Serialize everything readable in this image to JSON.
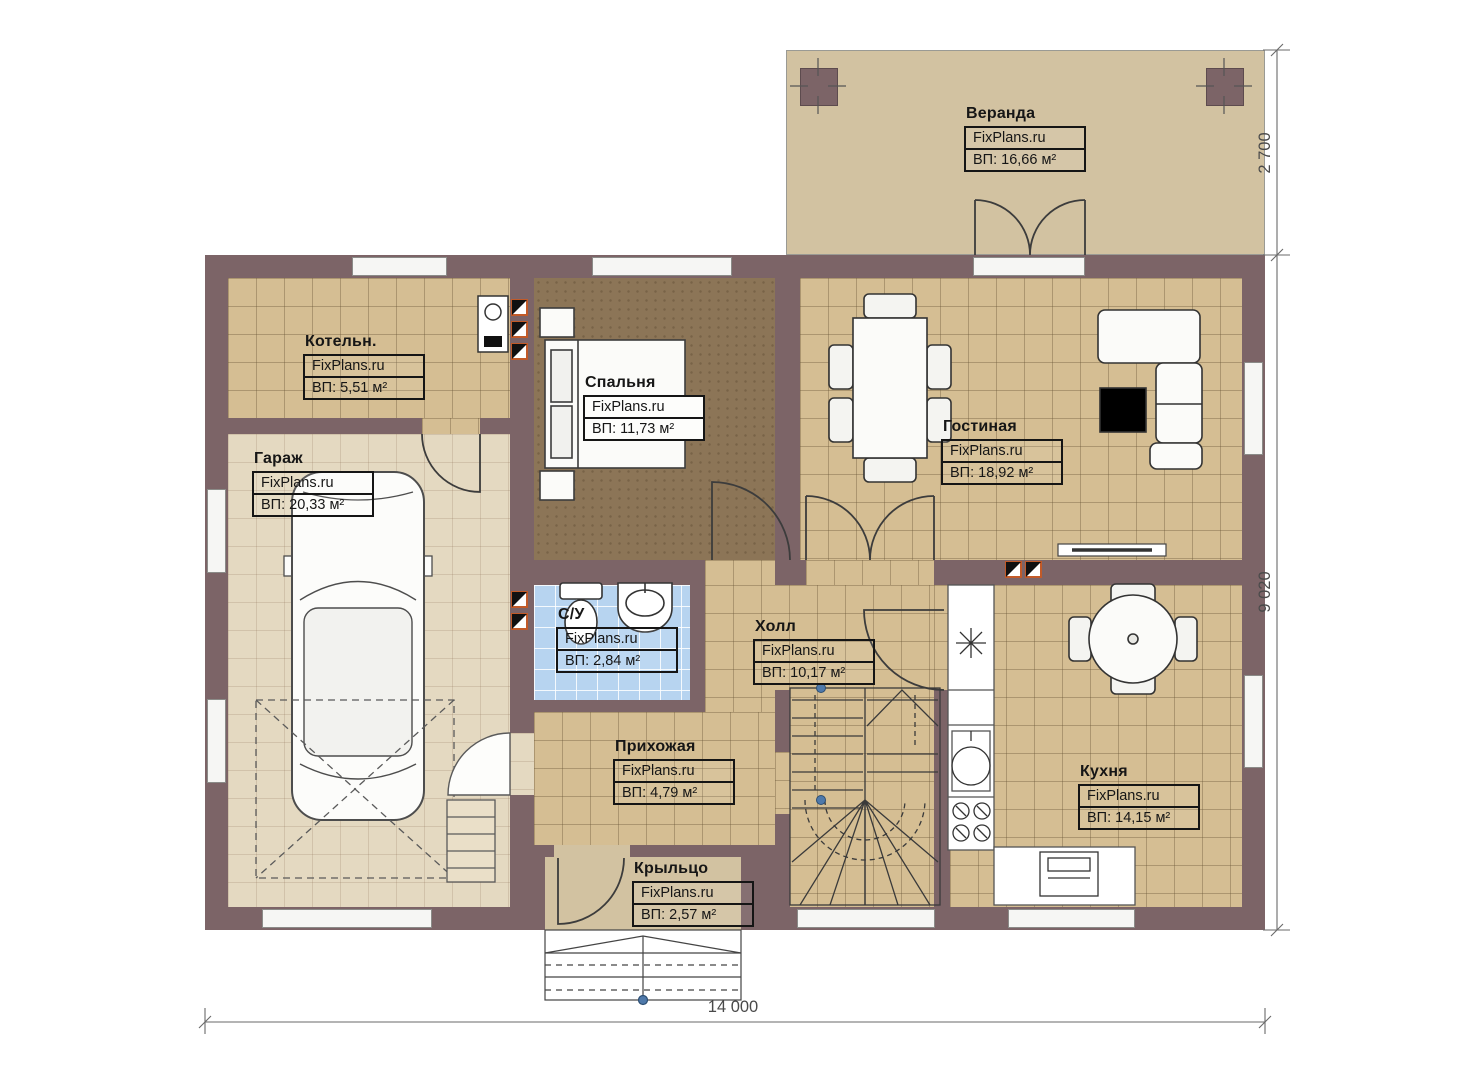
{
  "watermark": "FixPlans.ru",
  "rooms": [
    {
      "id": "veranda",
      "name": "Веранда",
      "area": "ВП: 16,66 м²"
    },
    {
      "id": "boiler",
      "name": "Котельн.",
      "area": "ВП: 5,51 м²"
    },
    {
      "id": "garage",
      "name": "Гараж",
      "area": "ВП: 20,33 м²"
    },
    {
      "id": "bedroom",
      "name": "Спальня",
      "area": "ВП: 11,73 м²"
    },
    {
      "id": "living",
      "name": "Гостиная",
      "area": "ВП: 18,92 м²"
    },
    {
      "id": "bathroom",
      "name": "С/У",
      "area": "ВП: 2,84 м²"
    },
    {
      "id": "hall",
      "name": "Холл",
      "area": "ВП: 10,17 м²"
    },
    {
      "id": "hallway",
      "name": "Прихожая",
      "area": "ВП: 4,79 м²"
    },
    {
      "id": "kitchen",
      "name": "Кухня",
      "area": "ВП: 14,15 м²"
    },
    {
      "id": "porch",
      "name": "Крыльцо",
      "area": "ВП: 2,57 м²"
    }
  ],
  "dimensions": {
    "veranda_depth": "2 700",
    "house_depth": "9 020",
    "house_width": "14 000"
  },
  "colors": {
    "wall": "#7c6467",
    "floor_tile": "#d5be93",
    "veranda_floor": "#d2c2a1",
    "garage_floor": "#e4d9c1",
    "bedroom_floor": "#8c7557",
    "bathroom_floor": "#b7d4f0",
    "vent_accent": "#c25a28",
    "dimension_text": "#4a4a4a"
  }
}
